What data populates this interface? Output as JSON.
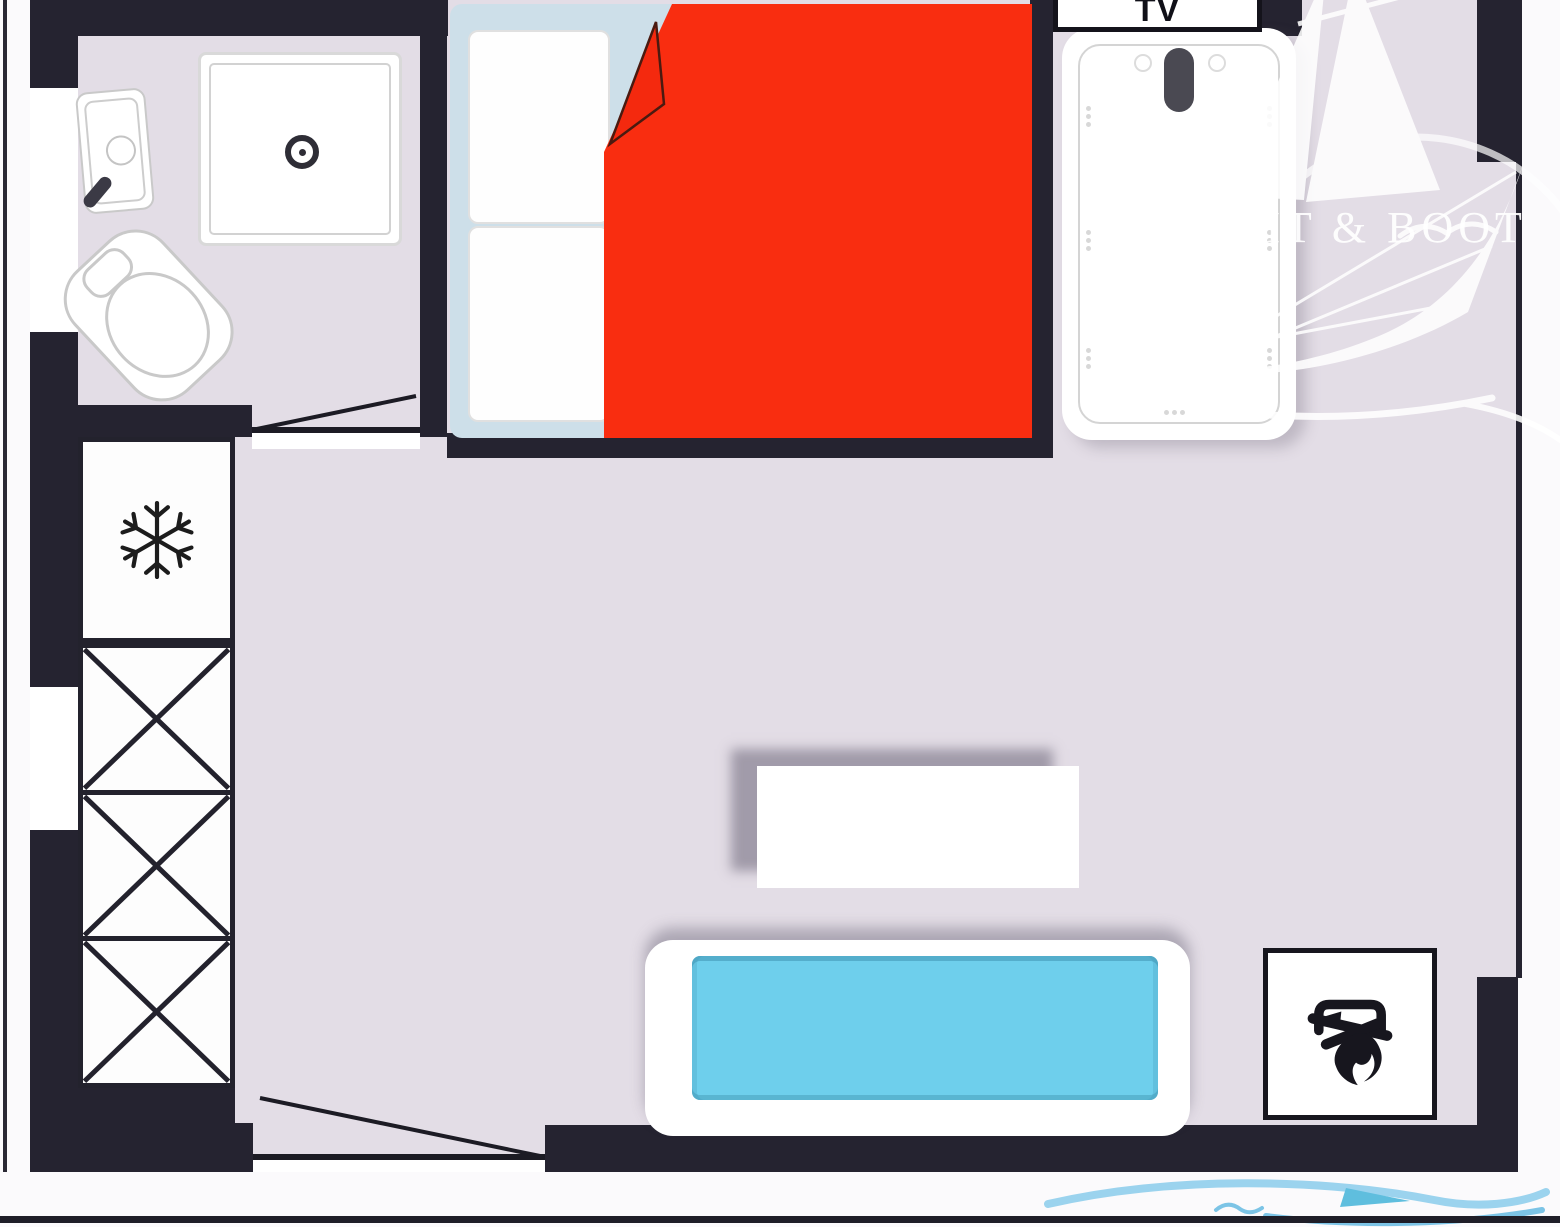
{
  "title": "studio-cabin-floor-plan",
  "labels": {
    "tv": "TV"
  },
  "watermark": {
    "brand": "YACHT & BOOT"
  },
  "colors": {
    "wall": "#252330",
    "floor": "#e3dde6",
    "outside": "#fbfafc",
    "bed_frame": "#cddfe9",
    "blanket_red": "#f92d10",
    "sofa_cushion": "#6ecfec",
    "icon_dark": "#17161e",
    "watermark_white": "#ffffff",
    "watermark_blue": "#8fd0ec"
  },
  "icons": {
    "snowflake": "snowflake-icon",
    "bonfire": "bonfire-icon",
    "shower_drain": "shower-drain-icon",
    "faucet_handle": "faucet-handle-icon",
    "door_swing": "door-swing-line",
    "wardrobe_cross": "crossed-box-icon",
    "sailboat": "sailboat-watermark-icon",
    "wave_boat": "boat-wave-watermark-icon"
  }
}
